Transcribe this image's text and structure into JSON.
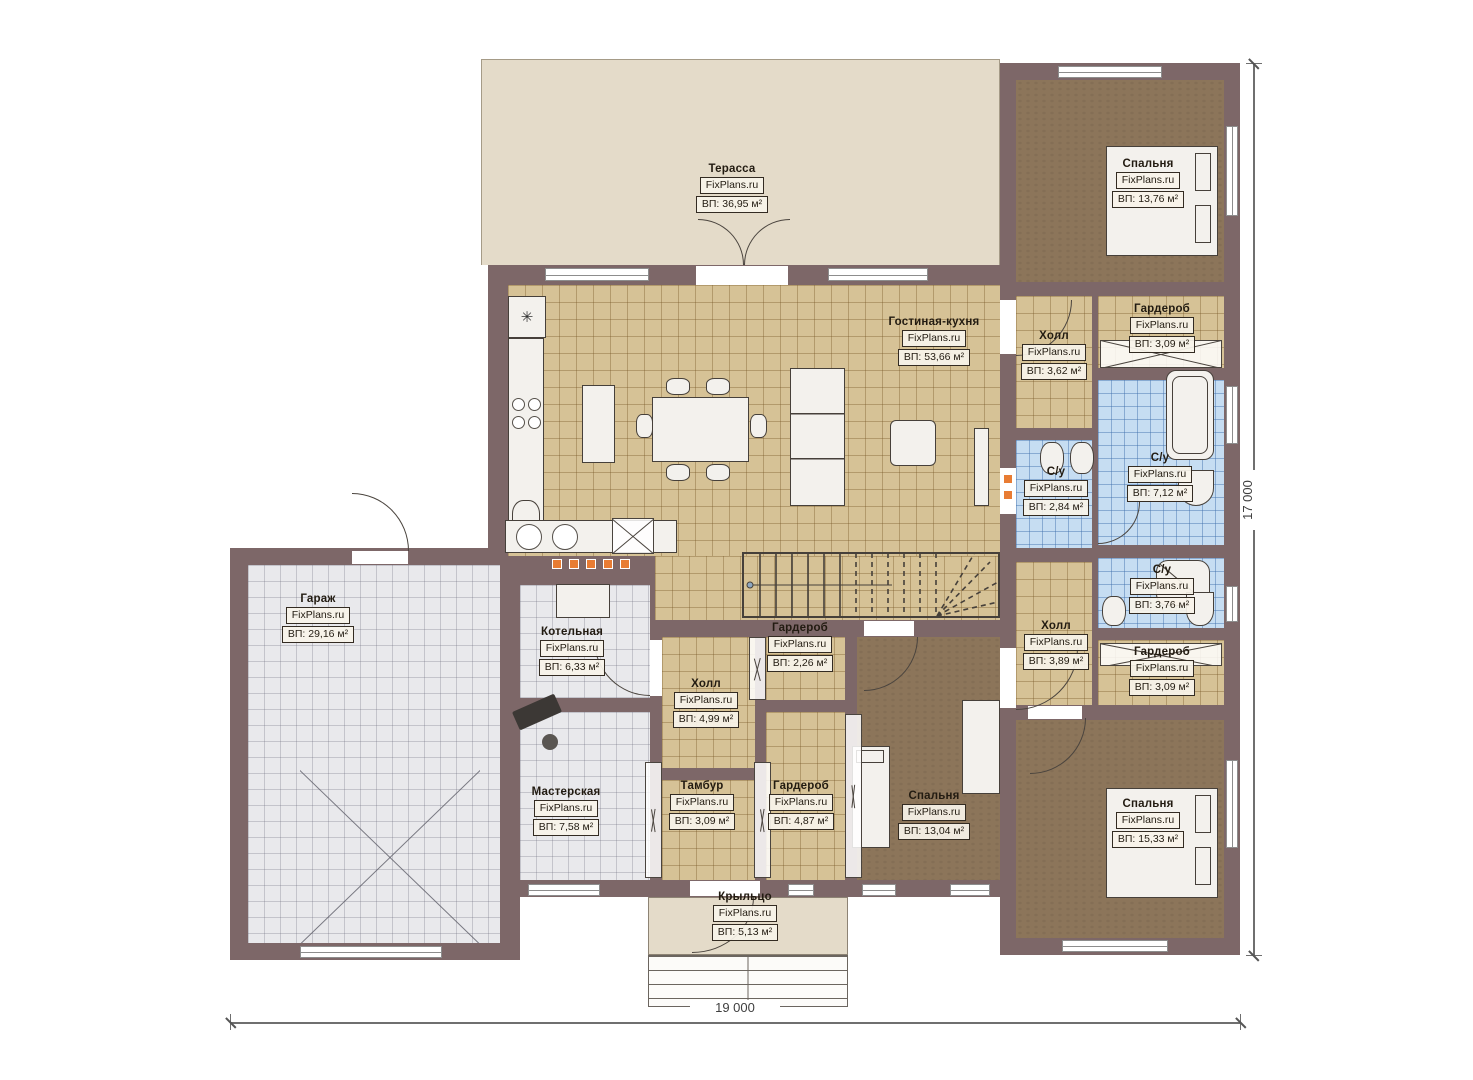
{
  "plan": {
    "brand": "FixPlans.ru",
    "rooms": [
      {
        "name": "Терасса",
        "area": "ВП: 36,95 м²"
      },
      {
        "name": "Гостиная-кухня",
        "area": "ВП: 53,66 м²"
      },
      {
        "name": "Спальня",
        "area": "ВП: 13,76 м²"
      },
      {
        "name": "Холл",
        "area": "ВП: 3,62 м²"
      },
      {
        "name": "Гардероб",
        "area": "ВП: 3,09 м²"
      },
      {
        "name": "С/у",
        "area": "ВП: 2,84 м²"
      },
      {
        "name": "С/у",
        "area": "ВП: 7,12 м²"
      },
      {
        "name": "С/у",
        "area": "ВП: 3,76 м²"
      },
      {
        "name": "Холл",
        "area": "ВП: 3,89 м²"
      },
      {
        "name": "Гардероб",
        "area": "ВП: 3,09 м²"
      },
      {
        "name": "Спальня",
        "area": "ВП: 15,33 м²"
      },
      {
        "name": "Гараж",
        "area": "ВП: 29,16 м²"
      },
      {
        "name": "Котельная",
        "area": "ВП: 6,33 м²"
      },
      {
        "name": "Холл",
        "area": "ВП: 4,99 м²"
      },
      {
        "name": "Гардероб",
        "area": "ВП: 2,26 м²"
      },
      {
        "name": "Мастерская",
        "area": "ВП: 7,58 м²"
      },
      {
        "name": "Тамбур",
        "area": "ВП: 3,09 м²"
      },
      {
        "name": "Гардероб",
        "area": "ВП: 4,87 м²"
      },
      {
        "name": "Спальня",
        "area": "ВП: 13,04 м²"
      },
      {
        "name": "Крыльцо",
        "area": "ВП: 5,13 м²"
      }
    ],
    "dimensions": {
      "width_label": "19 000",
      "height_label": "17 000"
    },
    "icons": {
      "snowflake": "✳"
    },
    "colors": {
      "wall": "#7d6768",
      "tan": "#d6c296",
      "blue": "#c6ddf2",
      "gray": "#e9e9ec",
      "brown": "#8c755a",
      "terrace": "#e4dbc9",
      "accent": "#e87c33"
    }
  }
}
